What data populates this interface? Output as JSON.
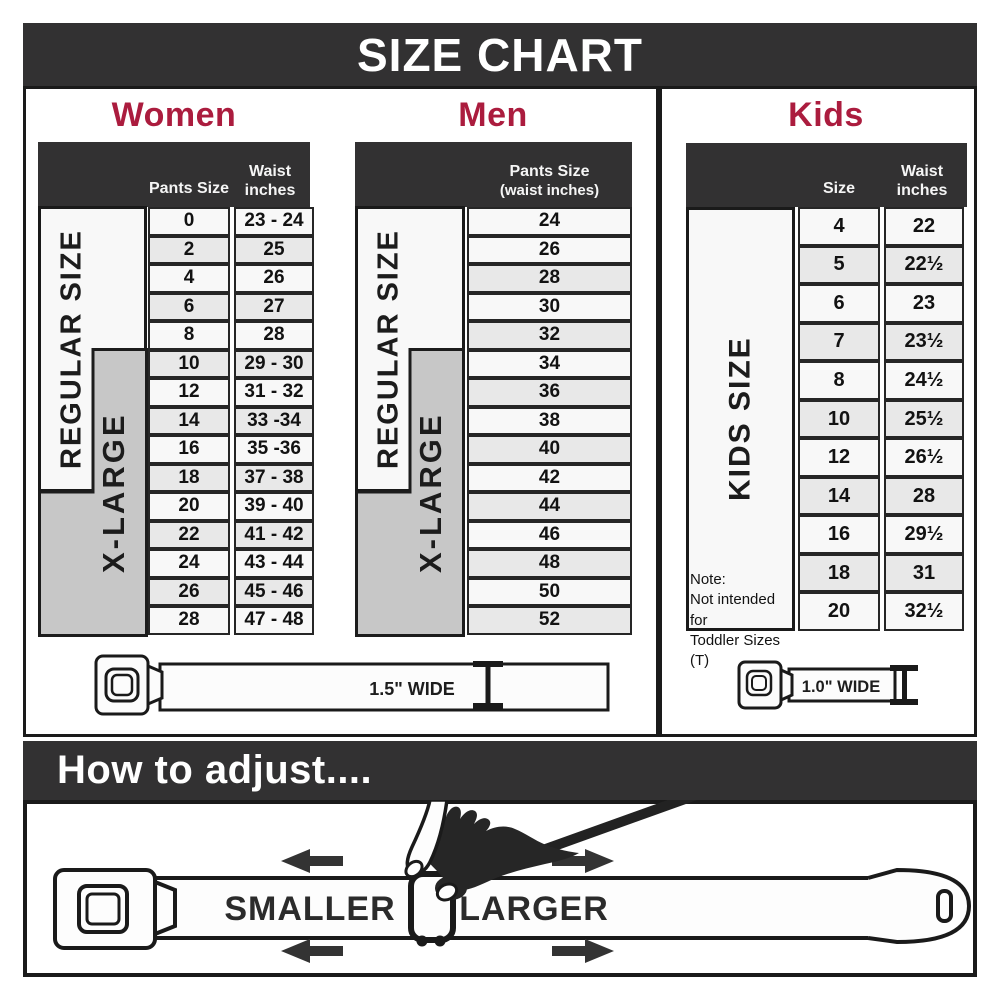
{
  "title": "SIZE CHART",
  "colors": {
    "accent_crimson": "#AB1C3E",
    "charcoal": "#323132",
    "table_border": "#262626",
    "row_light": "#f8f8f8",
    "row_shade": "#e8e8e8",
    "xlarge_gray": "#c7c7c7"
  },
  "women": {
    "heading": "Women",
    "col1_header": "Pants Size",
    "col2_header_line1": "Waist",
    "col2_header_line2": "inches",
    "regular_label": "REGULAR SIZE",
    "xlarge_label": "X-LARGE",
    "rows": [
      {
        "size": "0",
        "waist": "23 - 24"
      },
      {
        "size": "2",
        "waist": "25"
      },
      {
        "size": "4",
        "waist": "26"
      },
      {
        "size": "6",
        "waist": "27"
      },
      {
        "size": "8",
        "waist": "28"
      },
      {
        "size": "10",
        "waist": "29 - 30"
      },
      {
        "size": "12",
        "waist": "31 - 32"
      },
      {
        "size": "14",
        "waist": "33 -34"
      },
      {
        "size": "16",
        "waist": "35 -36"
      },
      {
        "size": "18",
        "waist": "37 - 38"
      },
      {
        "size": "20",
        "waist": "39 - 40"
      },
      {
        "size": "22",
        "waist": "41 - 42"
      },
      {
        "size": "24",
        "waist": "43 - 44"
      },
      {
        "size": "26",
        "waist": "45 - 46"
      },
      {
        "size": "28",
        "waist": "47 - 48"
      }
    ]
  },
  "men": {
    "heading": "Men",
    "col_header_line1": "Pants Size",
    "col_header_line2": "(waist inches)",
    "regular_label": "REGULAR SIZE",
    "xlarge_label": "X-LARGE",
    "rows": [
      "24",
      "26",
      "28",
      "30",
      "32",
      "34",
      "36",
      "38",
      "40",
      "42",
      "44",
      "46",
      "48",
      "50",
      "52"
    ]
  },
  "kids": {
    "heading": "Kids",
    "col1_header": "Size",
    "col2_header_line1": "Waist",
    "col2_header_line2": "inches",
    "side_label": "KIDS SIZE",
    "note_line1": "Note:",
    "note_line2": "Not intended for",
    "note_line3": "Toddler Sizes (T)",
    "rows": [
      {
        "size": "4",
        "waist": "22"
      },
      {
        "size": "5",
        "waist": "22½"
      },
      {
        "size": "6",
        "waist": "23"
      },
      {
        "size": "7",
        "waist": "23½"
      },
      {
        "size": "8",
        "waist": "24½"
      },
      {
        "size": "10",
        "waist": "25½"
      },
      {
        "size": "12",
        "waist": "26½"
      },
      {
        "size": "14",
        "waist": "28"
      },
      {
        "size": "16",
        "waist": "29½"
      },
      {
        "size": "18",
        "waist": "31"
      },
      {
        "size": "20",
        "waist": "32½"
      }
    ]
  },
  "belts": {
    "adult_width_label": "1.5\" WIDE",
    "kids_width_label": "1.0\" WIDE"
  },
  "adjust": {
    "heading": "How to adjust....",
    "smaller_label": "SMALLER",
    "larger_label": "LARGER"
  }
}
